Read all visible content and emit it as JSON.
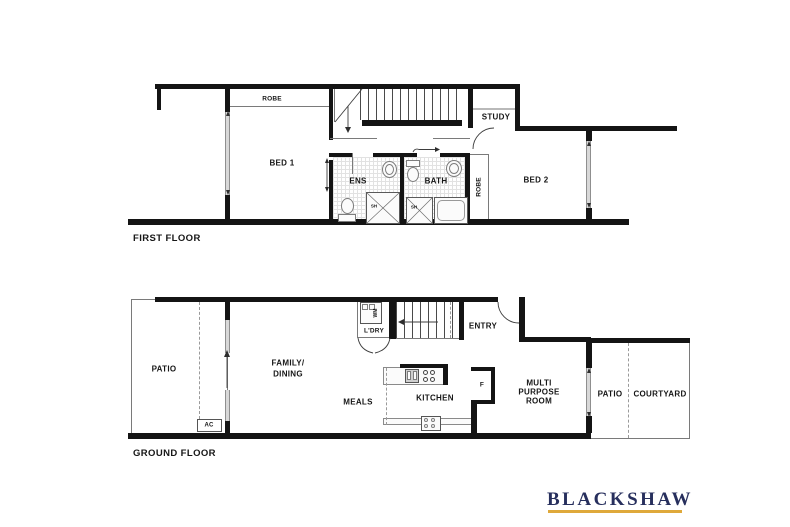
{
  "first_floor": {
    "title": "FIRST FLOOR",
    "labels": {
      "robe1": "ROBE",
      "bed1": "BED 1",
      "ens": "ENS",
      "bath": "BATH",
      "robe2": "ROBE",
      "study": "STUDY",
      "bed2": "BED 2",
      "shower_ens": "SH",
      "shower_bath": "SH"
    }
  },
  "ground_floor": {
    "title": "GROUND FLOOR",
    "labels": {
      "patio": "PATIO",
      "family_line1": "FAMILY/",
      "family_line2": "DINING",
      "meals": "MEALS",
      "kitchen": "KITCHEN",
      "ldry": "L'DRY",
      "wm": "WM",
      "ac": "AC",
      "entry": "ENTRY",
      "fridge": "F",
      "multi_line1": "MULTI",
      "multi_line2": "PURPOSE",
      "multi_line3": "ROOM",
      "patio2": "PATIO",
      "courtyard": "COURTYARD"
    }
  },
  "brand": {
    "name": "BLACKSHAW",
    "navy": "#272f5d",
    "gold": "#dfa93b"
  },
  "colors": {
    "wall": "#141414",
    "window": "#d8d8d8"
  }
}
